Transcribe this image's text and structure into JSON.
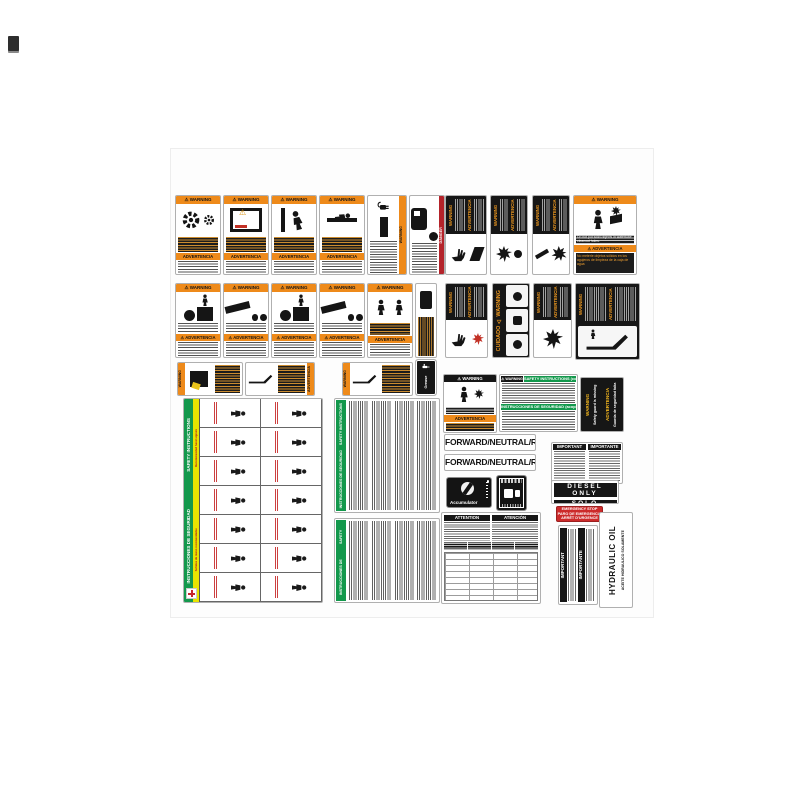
{
  "strings": {
    "warning_hdr": "⚠ WARNING",
    "warning": "WARNING",
    "advertencia": "ADVERTENCIA",
    "advertencia_hdr": "⚠ ADVERTENCIA",
    "danger": "DANGER",
    "cuidado_warning": "CUIDADO ⚠ WARNING"
  },
  "labels": {
    "watertube": {
      "en": "Do not put solid objects in watertube cleanout holes.",
      "es": "No meterle objetos sólidos en los agujeros de limpieza de la caja de agua"
    },
    "coupling": {
      "en": "SAFETY INSTRUCTIONS (coupling)",
      "es": "INSTRUCCIONES DE SEGURIDAD (acoplamiento)"
    },
    "guard": {
      "en": "Safety guard is missing",
      "es": "Guarda de seguridad falta"
    },
    "fnr": "FORWARD/NEUTRAL/REVERSE",
    "accumulator": "Accumulator",
    "diesel": {
      "en": "DIESEL ONLY",
      "es": "SÓLO DIESEL"
    },
    "emergency": {
      "en": "EMERGENCY STOP",
      "es": "PARO DE EMERGENCIA",
      "fr": "ARRÊT D'URGENCE"
    },
    "attention": {
      "en": "ATTENTION",
      "es": "ATENCIÓN"
    },
    "important": {
      "en": "IMPORTANT",
      "es": "IMPORTANTE"
    },
    "hydraulic": {
      "en": "HYDRAULIC OIL ONLY",
      "es": "ACEITE HIDRAULICO SOLAMENTE"
    },
    "hand_chart": {
      "title_es": "INSTRUCCIONES DE SEGURIDAD",
      "title_en": "SAFETY INSTRUCTIONS",
      "subtitle_es": "Señales de mano recomendadas",
      "subtitle_en": "Recommended hand signals"
    },
    "safety": {
      "en": "SAFETY INSTRUCTIONS",
      "es": "INSTRUCCIONES DE SEGURIDAD"
    },
    "grease": "Grease Point"
  },
  "colors": {
    "orange": "#ee8a1a",
    "black": "#161616",
    "green": "#13984c",
    "yellow": "#e8e400",
    "red": "#cc2a2a",
    "danger_red": "#b4232a",
    "border_gray": "#b0b0b0"
  }
}
